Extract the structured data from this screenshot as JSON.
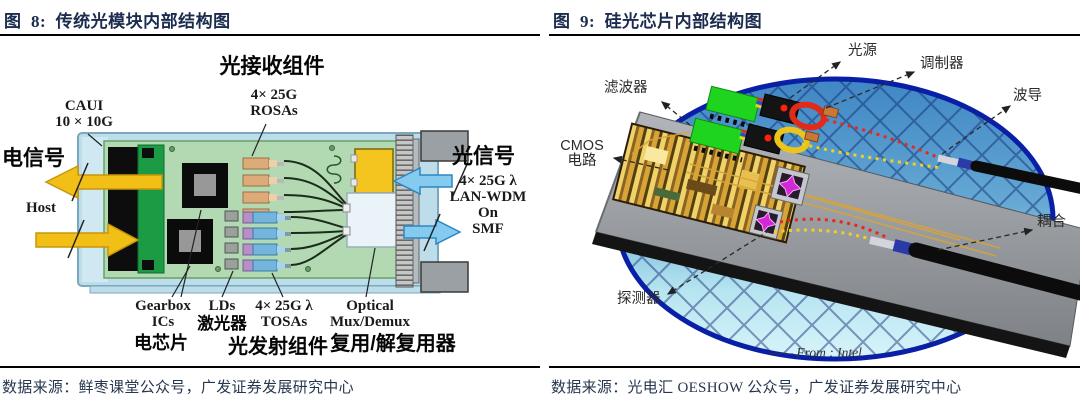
{
  "theme": {
    "--title-navy": "#1c2c4e",
    "--source-navy": "#27374f",
    "--case-blue": "#bcdde9",
    "--pcb-green": "#b2d9b2",
    "--conn-green": "#1d9a44",
    "--arrow-yellow": "#f2bf17",
    "--arrow-blue": "#85cbf0",
    "--rosa-tan": "#dcab79",
    "--tosa-blue": "#73b5dc",
    "--tosa-purple": "#b48fc9",
    "--mux-yellow": "#f4c51f",
    "--wafer-rim": "#0a1fa8",
    "--filter-green": "#1fd41f",
    "--ring-red": "#e02b18",
    "--ring-yellow": "#edc51a",
    "--star-magenta": "#d428d8",
    "--trace-gold": "#d8a437"
  },
  "figure8": {
    "title": "图  8:  传统光模块内部结构图",
    "source": "数据来源：鲜枣课堂公众号，广发证券发展研究中心",
    "labels": {
      "rx_assembly": "光接收组件",
      "rosas1": "4× 25G",
      "rosas2": "ROSAs",
      "caui1": "CAUI",
      "caui2": "10 × 10G",
      "electrical": "电信号",
      "host": "Host",
      "optical": "光信号",
      "wdm1": "4× 25G λ",
      "wdm2": "LAN-WDM",
      "wdm3": "On",
      "wdm4": "SMF",
      "gearbox1": "Gearbox",
      "gearbox2": "ICs",
      "lds": "LDs",
      "laser": "激光器",
      "tosas1": "4× 25G λ",
      "tosas2": "TOSAs",
      "mux1": "Optical",
      "mux2": "Mux/Demux",
      "echip": "电芯片",
      "tx_assembly": "光发射组件",
      "muxcn": "复用/解复用器"
    }
  },
  "figure9": {
    "title": "图  9:  硅光芯片内部结构图",
    "source": "数据来源：光电汇 OESHOW 公众号，广发证券发展研究中心",
    "labels": {
      "light_source": "光源",
      "modulator": "调制器",
      "waveguide": "波导",
      "filter": "滤波器",
      "cmos1": "CMOS",
      "cmos2": "电路",
      "detector": "探测器",
      "coupling": "耦合",
      "credit": "—— From : Intel"
    }
  }
}
